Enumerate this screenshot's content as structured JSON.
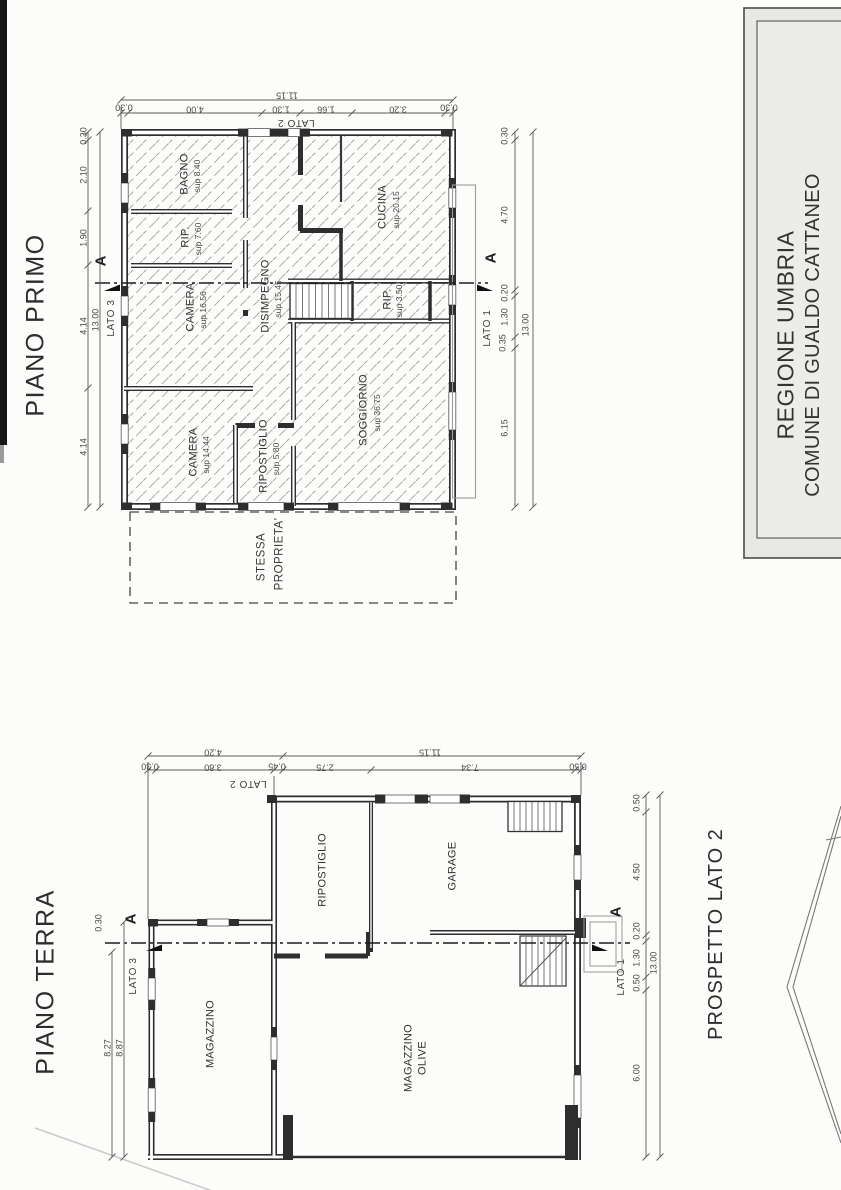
{
  "title_block": {
    "line1": "REGIONE UMBRIA",
    "line2": "COMUNE DI GUALDO CATTANEO"
  },
  "piano_primo": {
    "title": "PIANO PRIMO",
    "rooms": {
      "bagno": {
        "name": "BAGNO",
        "sup": "sup 8.40"
      },
      "rip_nord": {
        "name": "RIP.",
        "sup": "sup 7.60"
      },
      "camera_nord": {
        "name": "CAMERA",
        "sup": "sup 16.56"
      },
      "disimpegno": {
        "name": "DISIMPEGNO",
        "sup": "sup 15.45"
      },
      "cucina": {
        "name": "CUCINA",
        "sup": "sup 20.15"
      },
      "rip_scala": {
        "name": "RIP.",
        "sup": "sup 3.50"
      },
      "camera_sud": {
        "name": "CAMERA",
        "sup": "sup 14.44"
      },
      "ripostiglio": {
        "name": "RIPOSTIGLIO",
        "sup": "sup 5.80"
      },
      "soggiorno": {
        "name": "SOGGIORNO",
        "sup": "sup 36.75"
      }
    },
    "dims": {
      "top_total": "11.15",
      "top_segments": [
        "0.30",
        "4.00",
        "1.30",
        "1.66",
        "3.20",
        "0.30"
      ],
      "left_total": "13.00",
      "left_segments": [
        "0.30",
        "2.10",
        "1.90",
        "4.14",
        "4.14"
      ],
      "right_total": "13.00",
      "right_segments": [
        "0.30",
        "4.70",
        "0.20",
        "1.30",
        "0.35",
        "6.15"
      ]
    },
    "labels": {
      "lato1": "LATO 1",
      "lato2": "LATO 2",
      "lato3": "LATO 3",
      "section": "A",
      "adjacent_line1": "STESSA",
      "adjacent_line2": "PROPRIETA'"
    }
  },
  "piano_terra": {
    "title": "PIANO TERRA",
    "rooms": {
      "ripostiglio": {
        "name": "RIPOSTIGLIO"
      },
      "garage": {
        "name": "GARAGE"
      },
      "magazzino": {
        "name": "MAGAZZINO"
      },
      "magazzino_olive": {
        "line1": "MAGAZZINO",
        "line2": "OLIVE"
      }
    },
    "dims": {
      "top_total": "11.15",
      "top_left_total": "4.20",
      "top_segments": [
        "0.30",
        "3.80",
        "0.45",
        "2.75",
        "7.34",
        "0.50"
      ],
      "left_wall": "0.30",
      "left_inner": "8.27",
      "left_outer": "8.87",
      "right_total": "13.00",
      "right_segments": [
        "0.50",
        "4.50",
        "0.20",
        "1.30",
        "0.50",
        "6.00"
      ]
    },
    "labels": {
      "lato1": "LATO 1",
      "lato2": "LATO 2",
      "lato3": "LATO 3",
      "section": "A"
    }
  },
  "prospetto": {
    "title": "PROSPETTO LATO 2"
  }
}
